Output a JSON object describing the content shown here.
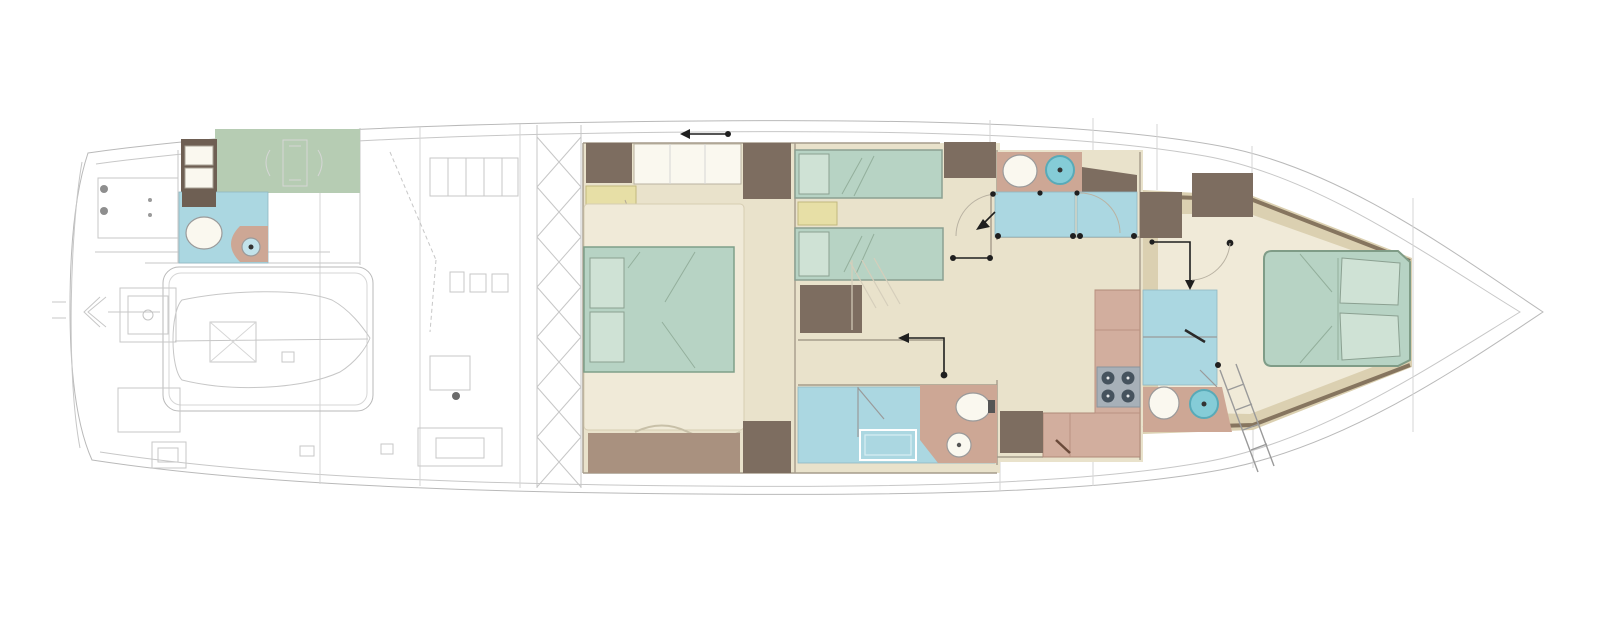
{
  "diagram": {
    "kind": "yacht-lower-deck-floor-plan",
    "orientation": "bow-to-the-right",
    "has_text_labels": false,
    "rooms": [
      {
        "id": "aft-crew-quarters",
        "features": [
          "bunk-beds",
          "crew-mess-green-floor",
          "crew-bathroom"
        ]
      },
      {
        "id": "engine-tender-garage",
        "features": [
          "technical-linework",
          "tender-outline"
        ]
      },
      {
        "id": "master-cabin",
        "features": [
          "double-bed",
          "two-nightstands",
          "wardrobes",
          "sofa",
          "dresser"
        ]
      },
      {
        "id": "twin-cabin",
        "features": [
          "two-single-beds",
          "nightstand",
          "wardrobe"
        ]
      },
      {
        "id": "master-bathroom",
        "features": [
          "shower",
          "bathtub",
          "toilet",
          "washbasin"
        ]
      },
      {
        "id": "twin-bathroom",
        "features": [
          "toilet",
          "washbasin",
          "shower-floor"
        ]
      },
      {
        "id": "galley",
        "features": [
          "l-shaped-counter",
          "four-burner-cooktop"
        ]
      },
      {
        "id": "vip-bathroom",
        "features": [
          "shower",
          "toilet",
          "washbasin"
        ]
      },
      {
        "id": "vip-cabin-bow",
        "features": [
          "island-double-bed",
          "wardrobes",
          "tapered-bow-floor"
        ]
      },
      {
        "id": "bow-staircase",
        "features": [
          "companionway-ladder"
        ]
      }
    ],
    "fixture_counts": {
      "toilets": 4,
      "washbasins": 4,
      "beds": 5,
      "bunk_berths": 2,
      "cooktops": 1
    }
  },
  "colors": {
    "floor": "#e9e2cb",
    "floor_light": "#f0ead8",
    "bow_tan": "#dbd0b1",
    "bow_band": "#86755f",
    "bed_green": "#b7d3c4",
    "bed_green_light": "#cfe2d5",
    "bath_blue": "#abd7e1",
    "bath_blue_light": "#c2e2ea",
    "crew_green": "#b6ccb3",
    "brown": "#7d6d60",
    "brown_dark": "#6e5f53",
    "mauve_brown": "#a9917f",
    "pink": "#cda795",
    "galley_pink": "#d2ae9e",
    "yellow": "#e7dfa6",
    "white_furniture": "#faf8ef",
    "stove_gray": "#a7b0b8",
    "burner": "#46535e",
    "sink_teal": "#85ccd7",
    "ink": "#1f1f1f"
  }
}
